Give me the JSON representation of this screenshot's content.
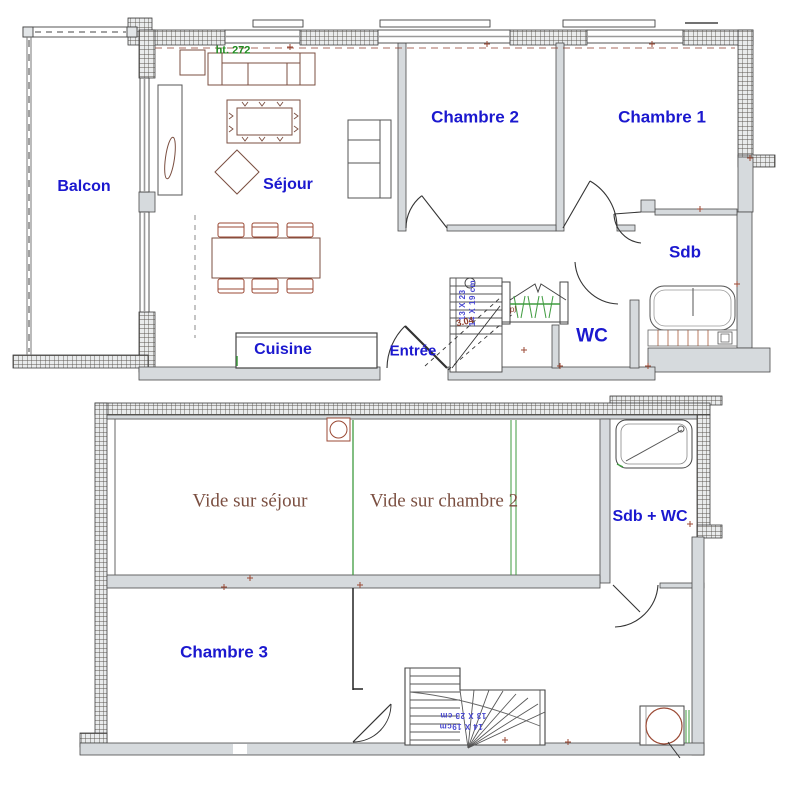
{
  "floor1": {
    "rooms": {
      "balcon": "Balcon",
      "sejour": "Séjour",
      "chambre2": "Chambre 2",
      "chambre1": "Chambre 1",
      "sdb": "Sdb",
      "wc": "WC",
      "cuisine": "Cuisine",
      "entree": "Entrée"
    },
    "annotations": {
      "ceiling_height": "ht. 272",
      "stair_dim_1": "14 X 19 cm",
      "stair_dim_2": "13 X 23",
      "stair_height": "3.04",
      "closet": "pl"
    }
  },
  "floor2": {
    "rooms": {
      "vide_sejour": "Vide sur séjour",
      "vide_chambre2": "Vide sur chambre 2",
      "sdb_wc": "Sdb + WC",
      "chambre3": "Chambre 3"
    },
    "annotations": {
      "stair_dim_1": "14 X 19cm",
      "stair_dim_2": "13 X 23 cm"
    }
  },
  "colors": {
    "room_label_blue": "#1b18cf",
    "height_note_green": "#1e8a1e",
    "vide_label_brown": "#7b4f41",
    "stair_text_blue": "#4a4ad0",
    "accent_maroon": "#9b4a35",
    "wall_gray": "#d6dadd",
    "hanger_green": "#3f9b3f"
  }
}
